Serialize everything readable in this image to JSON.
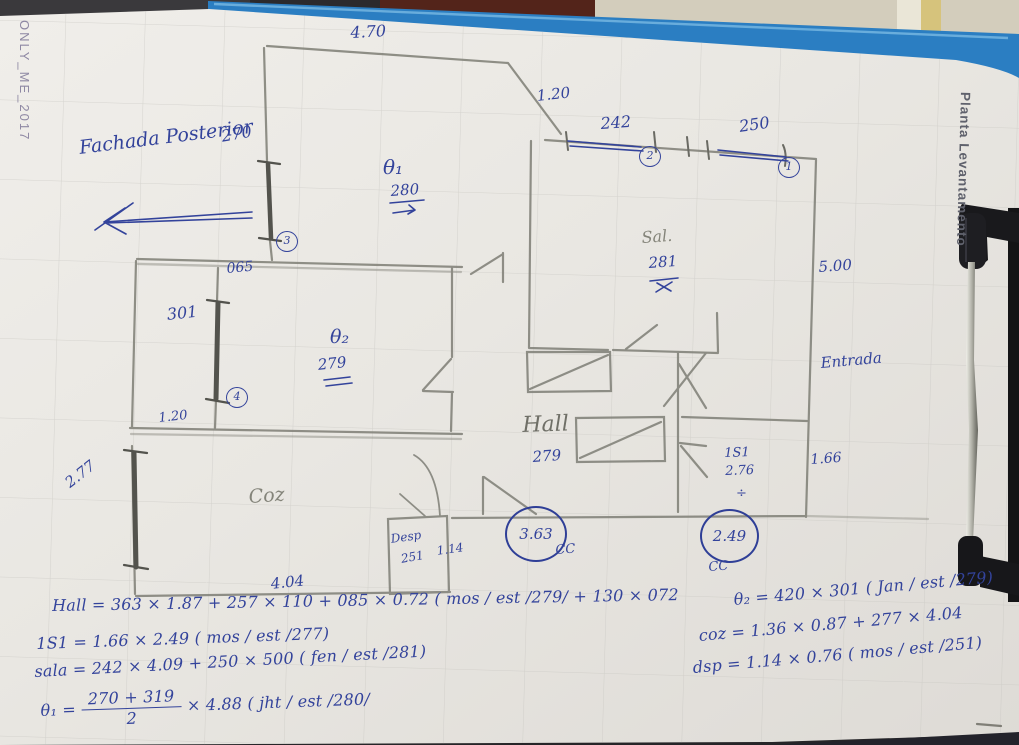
{
  "photo": {
    "side_left": "ONLY_ME_2017",
    "side_right": "Planta Levantamento"
  },
  "note": {
    "text": "Fachada Posterior"
  },
  "colors": {
    "ink": "#33439b",
    "pencil_wall": "#85857d",
    "window_graphite": "#53534d",
    "paper": "#e9e7e3",
    "clipboard_blue": "#2b7ec2"
  },
  "labels": [
    {
      "name": "dim-470",
      "text": "4.70",
      "x": 350,
      "y": 24,
      "s": 16,
      "r": -3
    },
    {
      "name": "dim-270",
      "text": "270",
      "x": 220,
      "y": 128,
      "s": 16,
      "r": -10
    },
    {
      "name": "dim-120-top",
      "text": "1.20",
      "x": 536,
      "y": 88,
      "s": 15,
      "r": -6
    },
    {
      "name": "dim-242",
      "text": "242",
      "x": 600,
      "y": 115,
      "s": 16,
      "r": -4
    },
    {
      "name": "dim-250",
      "text": "250",
      "x": 738,
      "y": 118,
      "s": 16,
      "r": -8
    },
    {
      "name": "room-q1",
      "text": "θ₁",
      "x": 383,
      "y": 156,
      "s": 20,
      "r": 0
    },
    {
      "name": "dim-q1-280",
      "text": "280",
      "x": 390,
      "y": 183,
      "s": 15,
      "r": -4
    },
    {
      "name": "dim-065",
      "text": "065",
      "x": 226,
      "y": 262,
      "s": 14,
      "r": -5
    },
    {
      "name": "dim-301",
      "text": "301",
      "x": 166,
      "y": 306,
      "s": 16,
      "r": -6
    },
    {
      "name": "room-q2",
      "text": "θ₂",
      "x": 330,
      "y": 327,
      "s": 19,
      "r": 0
    },
    {
      "name": "dim-q2-279",
      "text": "279",
      "x": 317,
      "y": 357,
      "s": 15,
      "r": -6
    },
    {
      "name": "dim-120-left",
      "text": "1.20",
      "x": 158,
      "y": 412,
      "s": 13,
      "r": -6
    },
    {
      "name": "dim-277",
      "text": "2.77",
      "x": 62,
      "y": 478,
      "s": 15,
      "r": -38
    },
    {
      "name": "room-coz",
      "text": "Coz",
      "x": 248,
      "y": 487,
      "s": 19,
      "r": -4,
      "ink": "pencil2"
    },
    {
      "name": "dim-404",
      "text": "4.04",
      "x": 270,
      "y": 576,
      "s": 15,
      "r": -6
    },
    {
      "name": "room-desp",
      "text": "Desp",
      "x": 390,
      "y": 533,
      "s": 12,
      "r": -8
    },
    {
      "name": "dim-desp-251",
      "text": "251",
      "x": 400,
      "y": 553,
      "s": 12,
      "r": -10
    },
    {
      "name": "dim-114",
      "text": "1.14",
      "x": 436,
      "y": 545,
      "s": 12,
      "r": -8
    },
    {
      "name": "room-hall",
      "text": "Hall",
      "x": 522,
      "y": 414,
      "s": 22,
      "r": -2,
      "ink": "pencil"
    },
    {
      "name": "dim-hall-279",
      "text": "279",
      "x": 532,
      "y": 449,
      "s": 15,
      "r": -4
    },
    {
      "name": "room-sala",
      "text": "Sal.",
      "x": 641,
      "y": 229,
      "s": 16,
      "r": -4,
      "ink": "pencil2"
    },
    {
      "name": "dim-sala-281",
      "text": "281",
      "x": 648,
      "y": 255,
      "s": 15,
      "r": -4
    },
    {
      "name": "dim-500",
      "text": "5.00",
      "x": 818,
      "y": 259,
      "s": 15,
      "r": -4
    },
    {
      "name": "label-entrada",
      "text": "Entrada",
      "x": 820,
      "y": 355,
      "s": 15,
      "r": -5
    },
    {
      "name": "room-is1",
      "text": "1S1",
      "x": 724,
      "y": 447,
      "s": 13,
      "r": -2
    },
    {
      "name": "dim-is1-276",
      "text": "2.76",
      "x": 725,
      "y": 465,
      "s": 13,
      "r": -2
    },
    {
      "name": "is1-divide-mark",
      "text": "÷",
      "x": 736,
      "y": 487,
      "s": 13,
      "r": 0
    },
    {
      "name": "dim-166",
      "text": "1.66",
      "x": 810,
      "y": 453,
      "s": 14,
      "r": -4
    },
    {
      "name": "label-cc-hall",
      "text": "CC",
      "x": 555,
      "y": 544,
      "s": 13,
      "r": -4
    },
    {
      "name": "label-cc-is1",
      "text": "CC",
      "x": 708,
      "y": 561,
      "s": 13,
      "r": -4
    }
  ],
  "circled_small": [
    {
      "n": "2",
      "x": 639,
      "y": 146
    },
    {
      "n": "1",
      "x": 778,
      "y": 157
    },
    {
      "n": "3",
      "x": 276,
      "y": 231
    },
    {
      "n": "4",
      "x": 226,
      "y": 387
    }
  ],
  "circled_big": [
    {
      "n": "3.63",
      "x": 505,
      "y": 506,
      "w": 58,
      "h": 52
    },
    {
      "n": "2.49",
      "x": 700,
      "y": 509,
      "w": 55,
      "h": 50
    }
  ],
  "equations": {
    "left": [
      {
        "name": "eq-hall",
        "x": 52,
        "y": 597,
        "r": -1,
        "text": "Hall = 363 × 1.87 + 257 × 110 + 085 × 0.72 ( mos / est /279/ + 130 × 072"
      },
      {
        "name": "eq-1s1",
        "x": 36,
        "y": 635,
        "r": -2,
        "text": "1S1 = 1.66 × 2.49 ( mos / est /277)"
      },
      {
        "name": "eq-sala",
        "x": 34,
        "y": 663,
        "r": -3,
        "text": "sala = 242 × 4.09 + 250 × 500 ( fen / est /281)"
      },
      {
        "name": "eq-q1",
        "x": 40,
        "y": 693,
        "r": -2,
        "frac": {
          "pre": "θ₁ =",
          "num": "270 + 319",
          "den": "2",
          "post": "× 4.88 ( jht / est /280/"
        }
      }
    ],
    "right": [
      {
        "name": "eq-q2",
        "x": 733,
        "y": 591,
        "r": -5,
        "text": "θ₂ = 420 × 301 ( Jan / est /279)"
      },
      {
        "name": "eq-coz",
        "x": 698,
        "y": 627,
        "r": -5,
        "text": "coz = 1.36 × 0.87 + 277 × 4.04"
      },
      {
        "name": "eq-dsp",
        "x": 692,
        "y": 659,
        "r": -5,
        "text": "dsp = 1.14 × 0.76 ( mos / est /251)"
      }
    ]
  }
}
